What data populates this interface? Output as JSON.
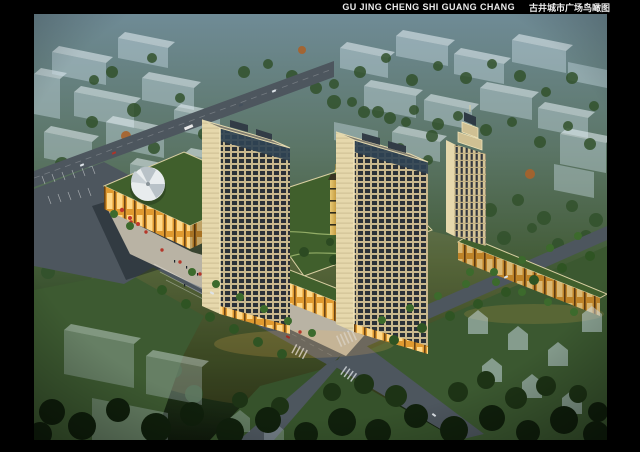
{
  "header": {
    "title_en": "GU JING CHENG SHI GUANG CHANG",
    "title_zh": "古井城市广场鸟瞰图"
  },
  "colors": {
    "frame": "#000000",
    "title_text": "#ececec",
    "haze_top": "#6f8b96",
    "mid_green": "#435c37",
    "ground_dark": "#101b0c",
    "road": "#4d565e",
    "tower_facade": "#c9b88e",
    "tower_glass": "#2b3138",
    "tower_trim": "#e6d8ac",
    "retail_base": "#e09a30",
    "retail_glow": "#ffd887",
    "green_roof": "#405f2c",
    "ghost_building": "#cfe0ea",
    "context_tree": "#31512b",
    "street_tree": "#3c6a2c",
    "foreground_tree": "#10200c",
    "umbrella_red": "#b5372a",
    "gold_tower": "#c49a3e",
    "tent_white": "#e8ecee",
    "plaza_paving": "#b9b3a4"
  }
}
